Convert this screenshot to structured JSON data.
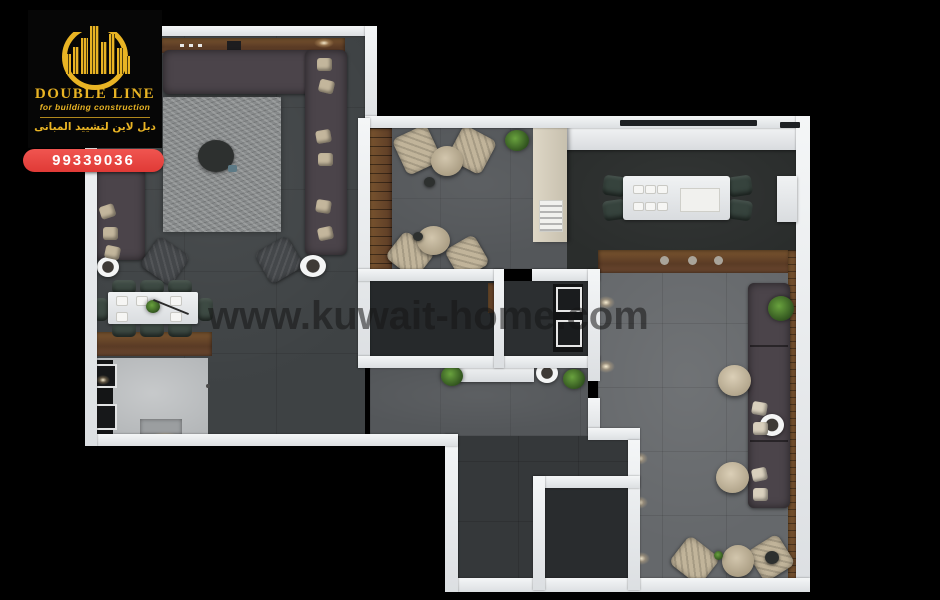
{
  "branding": {
    "company_name": "DOUBLE LINE",
    "tagline": "for building construction",
    "arabic_name": "دبل لاين لتشييد المبانى",
    "phone_number": "99339036",
    "brand_gold": "#E9B424",
    "badge_red": "#E8403B"
  },
  "watermark": {
    "text": "www.kuwait-home.com"
  },
  "scene": {
    "type": "3d-floor-plan-top-view-render",
    "background": "#000000",
    "wall_color": "#E8EAEC",
    "wood_color": "#6E4B33",
    "sofa_color": "#4B444A",
    "rooms": [
      "living-room",
      "dining-nook",
      "lounge-seating",
      "kitchen",
      "dining-room",
      "majlis",
      "bathroom",
      "storage-room",
      "laundry-room",
      "hallway"
    ]
  }
}
